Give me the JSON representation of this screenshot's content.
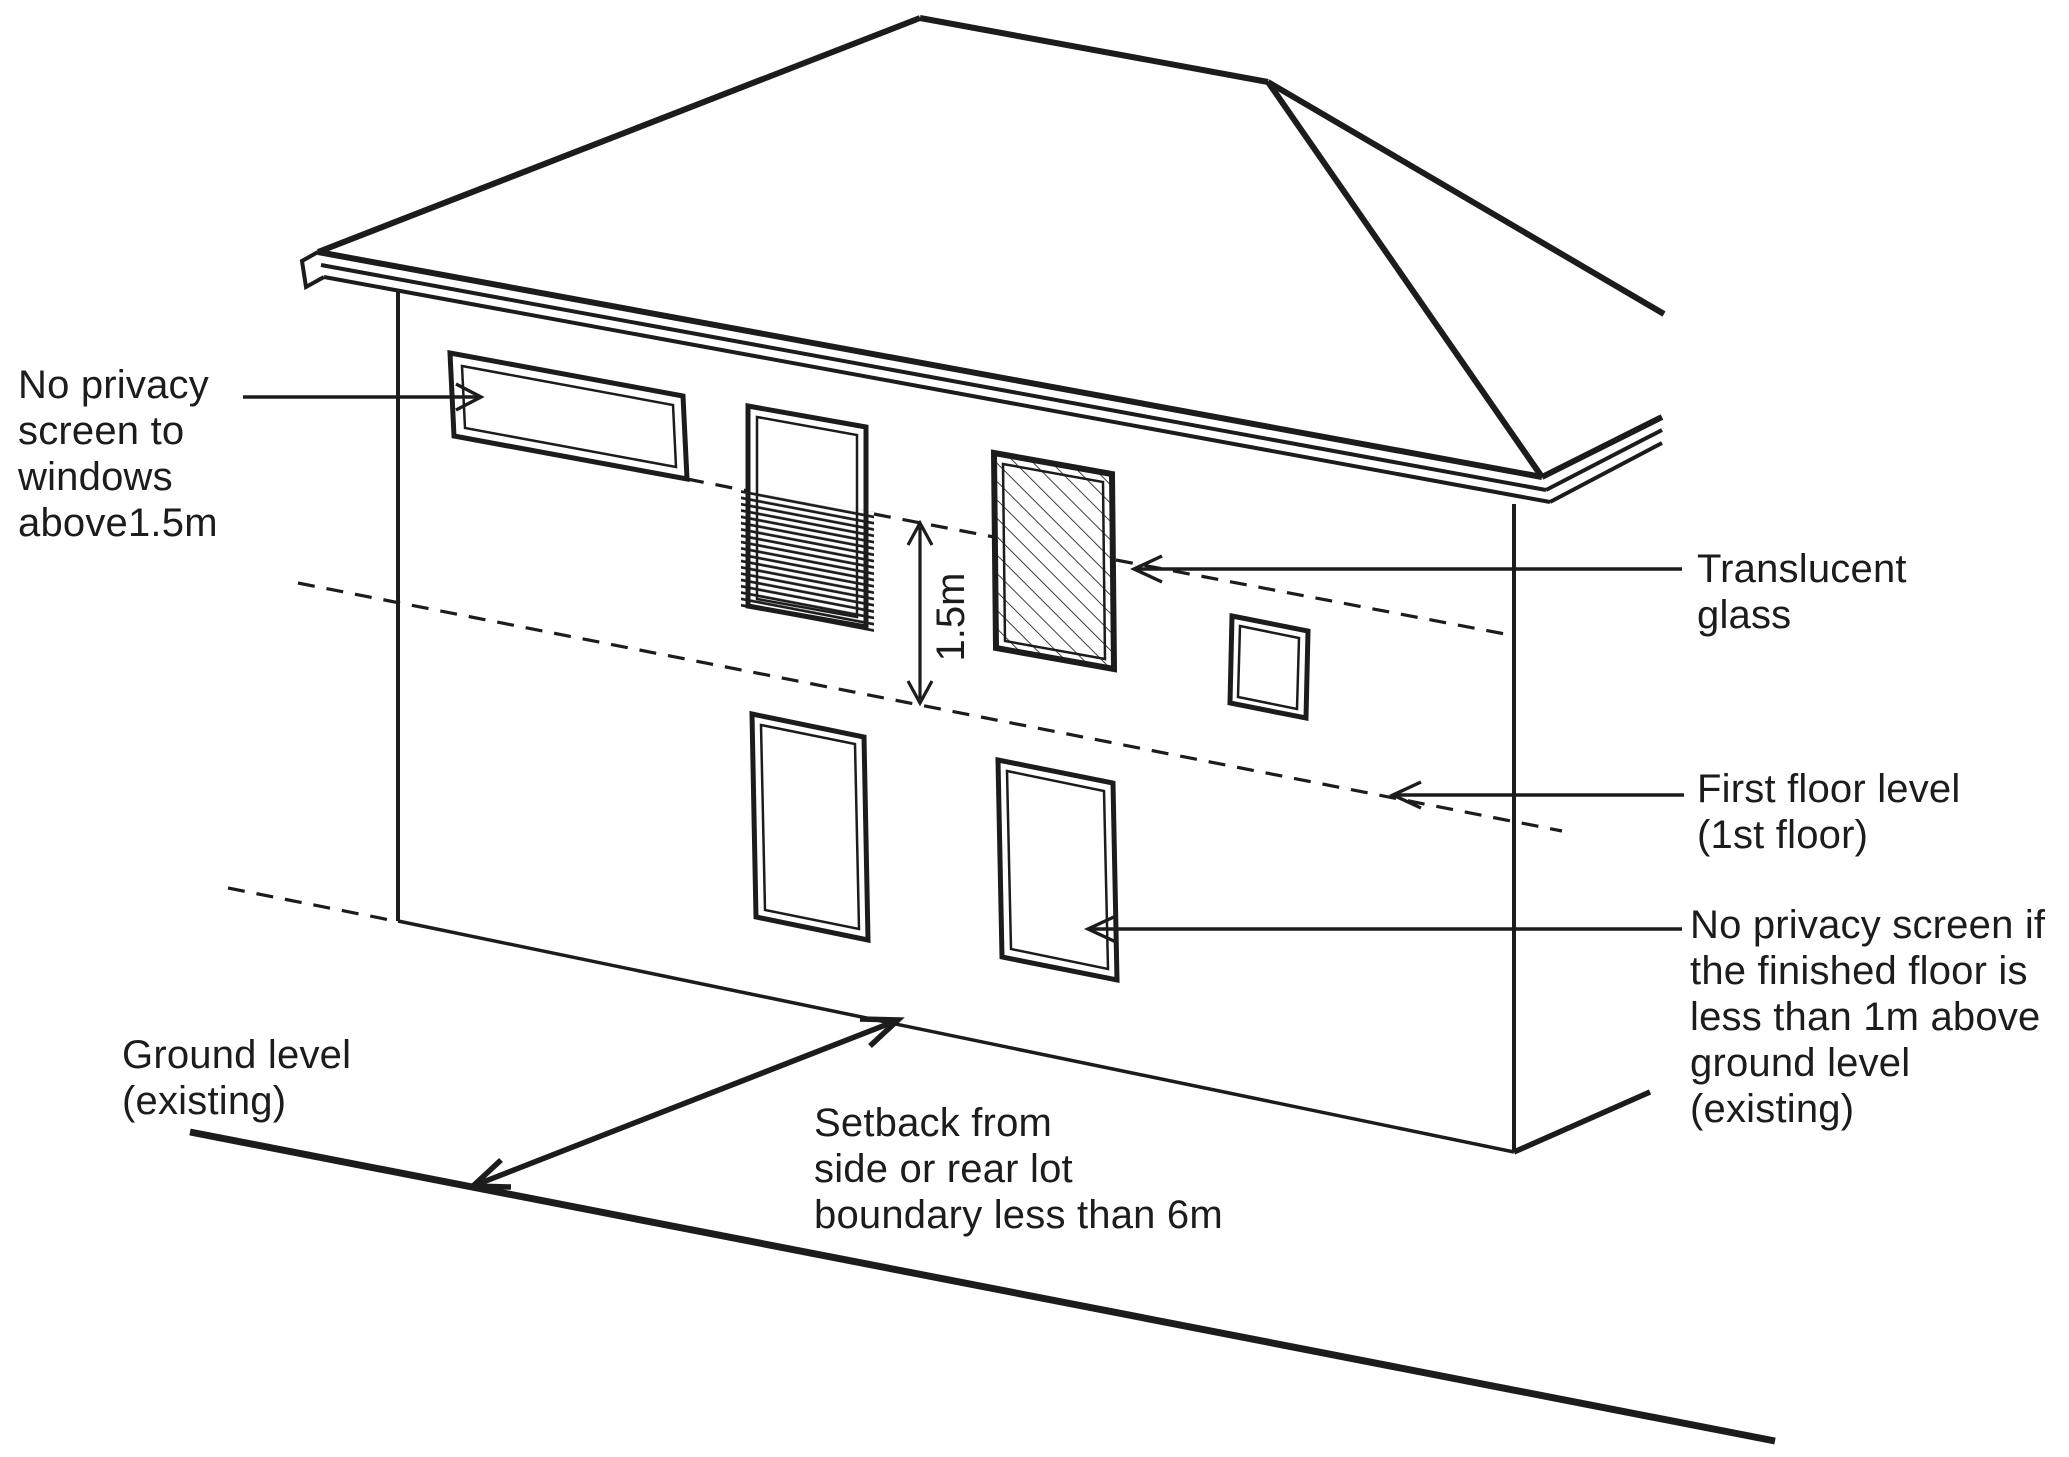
{
  "title": "Privacy screen requirements diagram",
  "colors": {
    "ink": "#1c1c1c",
    "background": "#ffffff"
  },
  "labels": {
    "no_screen_above": {
      "text": "No privacy\nscreen to\nwindows\nabove1.5m"
    },
    "translucent_glass": {
      "text": "Translucent\nglass"
    },
    "first_floor_level": {
      "text": "First floor level\n(1st floor)"
    },
    "no_screen_if": {
      "text": "No privacy screen if\nthe finished floor is\nless than 1m above\nground level (existing)"
    },
    "ground_level": {
      "text": "Ground level\n(existing)"
    },
    "setback": {
      "text": "Setback from\nside or rear lot\nboundary less than 6m"
    },
    "dimension_1_5m": {
      "text": "1.5m"
    }
  }
}
